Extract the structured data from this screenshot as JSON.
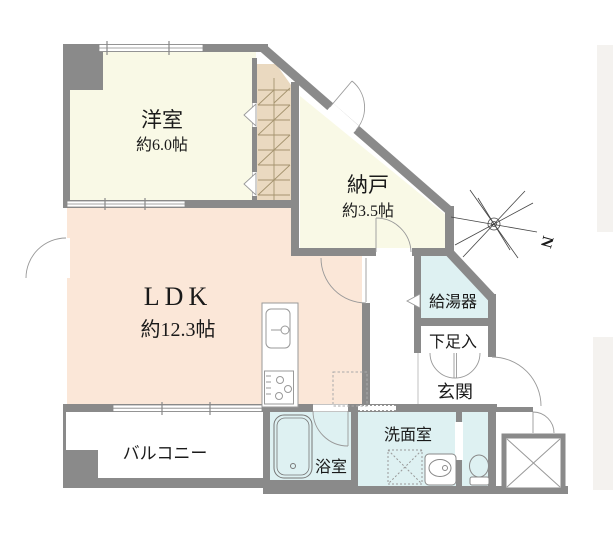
{
  "page": {
    "type": "floor-plan",
    "background": "#ffffff"
  },
  "colors": {
    "wall": "#8a8a8a",
    "room_cream": "#f9f9e6",
    "room_ldk": "#fbe7d8",
    "room_wet": "#def1f2",
    "closet": "#ead9c0",
    "closet_hatch": "#a5946f",
    "door_arc": "#999999",
    "outside_band": "#f4f2ef",
    "fixture_line": "#8a8a8a",
    "label": "#1a1a1a"
  },
  "rooms": [
    {
      "id": "youshitsu",
      "name": "洋室",
      "size": "約6.0帖"
    },
    {
      "id": "nando",
      "name": "納戸",
      "size": "約3.5帖"
    },
    {
      "id": "ldk",
      "name": "LDK",
      "size": "約12.3帖"
    },
    {
      "id": "kyutouki",
      "name": "給湯器",
      "size": ""
    },
    {
      "id": "kasokuire",
      "name": "下足入",
      "size": ""
    },
    {
      "id": "genkan",
      "name": "玄関",
      "size": ""
    },
    {
      "id": "senmenshitsu",
      "name": "洗面室",
      "size": ""
    },
    {
      "id": "yokushitsu",
      "name": "浴室",
      "size": ""
    },
    {
      "id": "balcony",
      "name": "バルコニー",
      "size": ""
    }
  ],
  "compass": {
    "label": "N"
  },
  "icons": {
    "compass": "eight-ray-star-with-N",
    "bathtub": "rounded-tub-outline",
    "toilet": "bowl-and-tank",
    "wash-basin": "counter-with-oval-basin",
    "washing-machine-space": "dotted-square-with-x",
    "kitchen-sink": "rounded-sink-with-tap",
    "gas-stove": "counter-with-burners",
    "refrigerator-space": "dotted-square",
    "elevator-shaft": "square-with-x",
    "closet": "hatched-strip",
    "doors": "quarter-circle-swing-arcs"
  }
}
